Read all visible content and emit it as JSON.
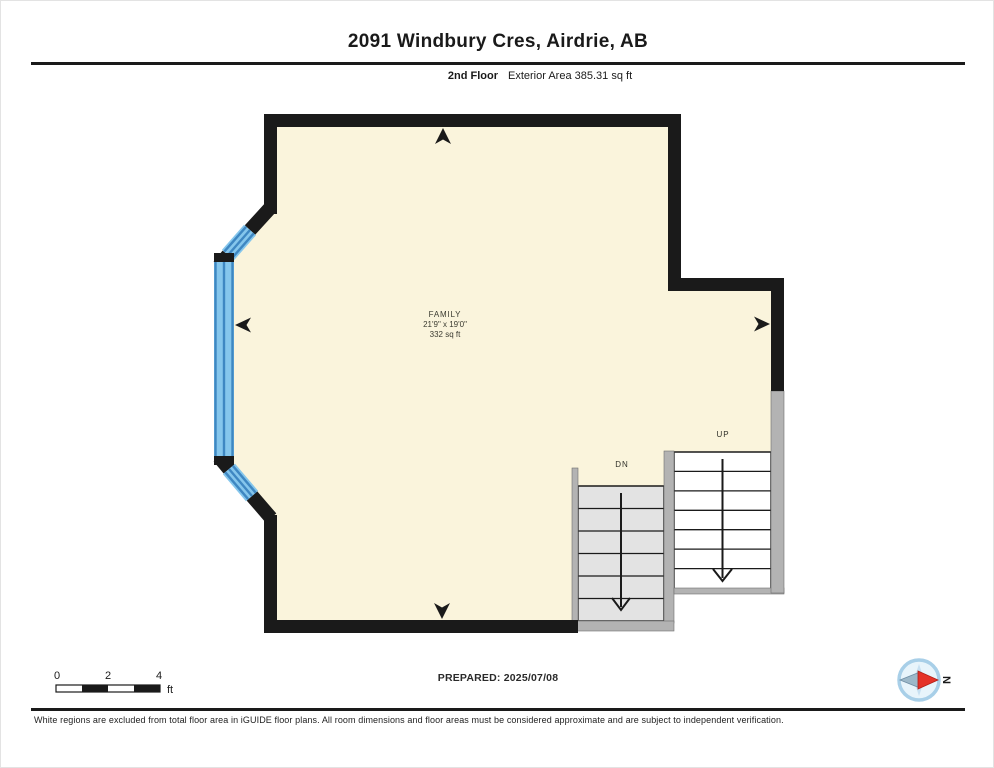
{
  "header": {
    "title": "2091 Windbury Cres, Airdrie, AB",
    "floor_label": "2nd Floor",
    "area_label": "Exterior Area 385.31 sq ft"
  },
  "plan": {
    "room": {
      "name": "FAMILY",
      "dimensions": "21'9\" x 19'0\"",
      "area": "332 sq ft"
    },
    "stairs": {
      "down_label": "DN",
      "up_label": "UP"
    }
  },
  "scale_bar": {
    "tick_0": "0",
    "tick_2": "2",
    "tick_4": "4",
    "unit": "ft"
  },
  "footer": {
    "prepared": "PREPARED: 2025/07/08",
    "disclaimer": "White regions are excluded from total floor area in iGUIDE floor plans. All room dimensions and floor areas must be considered approximate and are subject to independent verification.",
    "compass_north": "N"
  },
  "colors": {
    "wall_black": "#1a1a1a",
    "floor_cream": "#FAF4DC",
    "window_light_blue": "#85C6EC",
    "window_dark_blue": "#3E87C2",
    "knee_wall_gray": "#b3b3b3",
    "stair_dn_fill": "#e3e3e3",
    "stair_up_fill": "#ffffff",
    "compass_ring": "#A8CFE8",
    "compass_needle_red": "#E53228",
    "compass_needle_gray": "#9DB8C9"
  }
}
